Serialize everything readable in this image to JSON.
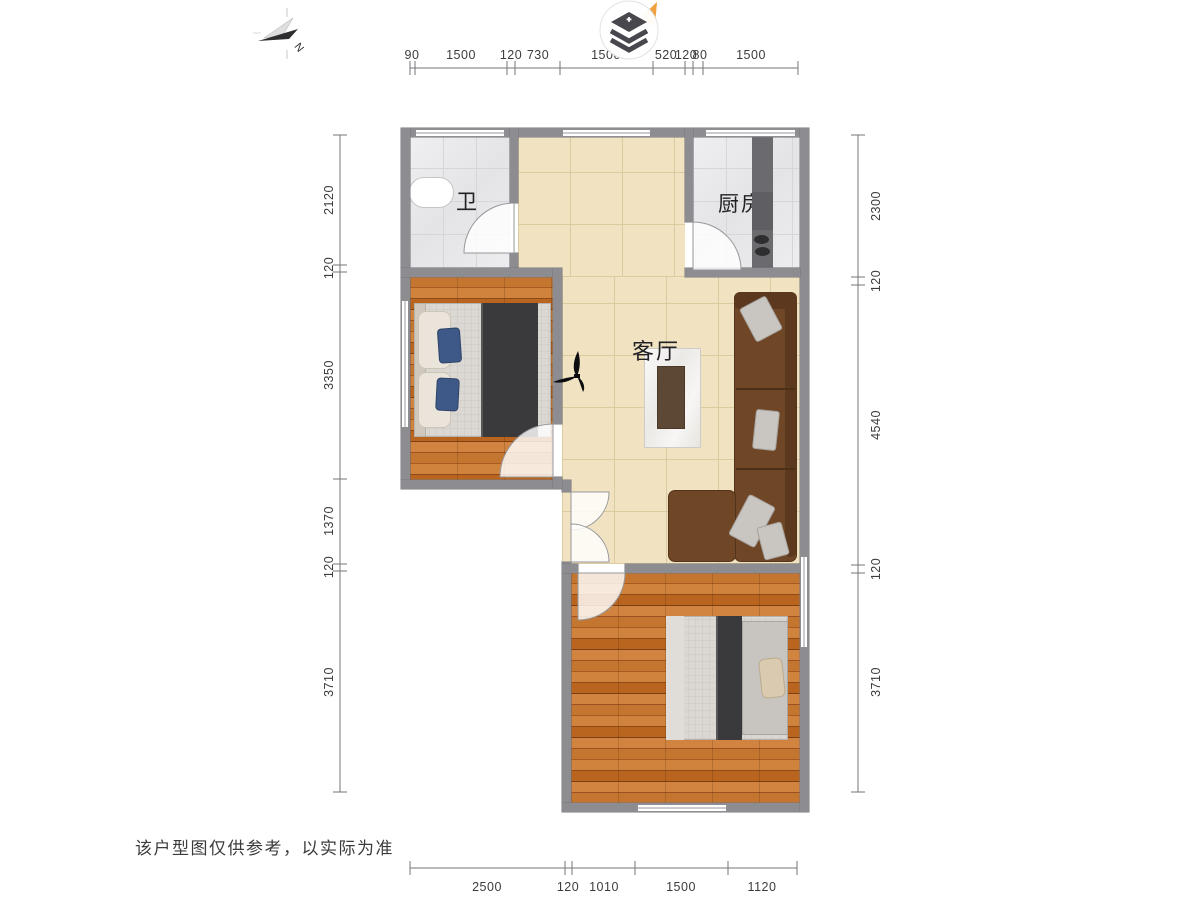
{
  "meta": {
    "disclaimer": "该户型图仅供参考，以实际为准"
  },
  "compass": {
    "north_label": "N"
  },
  "rooms": {
    "bathroom": "卫",
    "kitchen": "厨房",
    "living": "客厅"
  },
  "dims": {
    "top": [
      "90",
      "1500",
      "120",
      "730",
      "1500",
      "520",
      "120",
      "80",
      "1500"
    ],
    "bottom": [
      "2500",
      "120",
      "1010",
      "1500",
      "1120"
    ],
    "left": [
      "2120",
      "120",
      "3350",
      "1370",
      "120",
      "3710"
    ],
    "right": [
      "2300",
      "120",
      "4540",
      "120",
      "3710"
    ]
  },
  "colors": {
    "wall": "#8d8d91",
    "tile_floor": "#e9e9eb",
    "living_floor": "#f1e3c2",
    "wood_floor": "#b9641f",
    "sofa": "#6f4626",
    "blanket": "#3a3a3c",
    "logo_accent": "#f0a03c"
  }
}
